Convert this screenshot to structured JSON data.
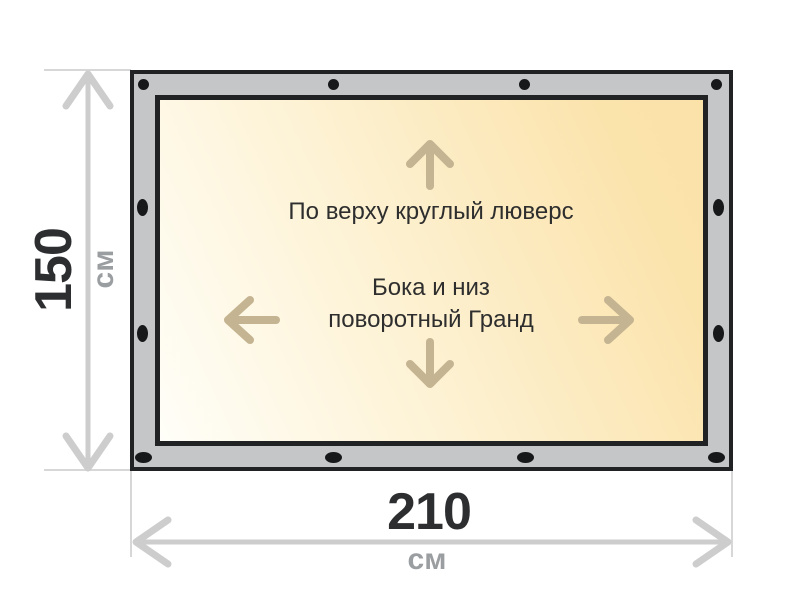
{
  "diagram": {
    "banner": {
      "top_note": "По верху круглый люверс",
      "mid_note": {
        "line1": "Бока и низ",
        "line2": "поворотный Гранд"
      }
    },
    "dimensions": {
      "height": {
        "value": "150",
        "unit": "см"
      },
      "width": {
        "value": "210",
        "unit": "см"
      }
    },
    "grommets": {
      "top_shape": "circle",
      "side_shape": "vertical-oval",
      "bottom_shape": "horizontal-oval",
      "top_count": 4,
      "bottom_count": 4,
      "left_count": 2,
      "right_count": 2
    },
    "icons": {
      "direction_arrows": [
        "up-arrow-icon",
        "down-arrow-icon",
        "left-arrow-icon",
        "right-arrow-icon"
      ],
      "dimension_arrows": [
        "height-dimension-arrow-icon",
        "width-dimension-arrow-icon"
      ]
    },
    "colors": {
      "frame_gray": "#c5c6c8",
      "frame_border": "#202224",
      "grommet_black": "#17181a",
      "canvas_gradient_light": "#fffef8",
      "canvas_gradient_dark": "#fbe2a9",
      "banner_text": "#2e2e2e",
      "direction_arrow": "#c5b491",
      "dimension_gray": "#cdcdcd",
      "dimension_value_text": "#2d2e30",
      "dimension_unit_text": "#9b9ea1"
    }
  }
}
